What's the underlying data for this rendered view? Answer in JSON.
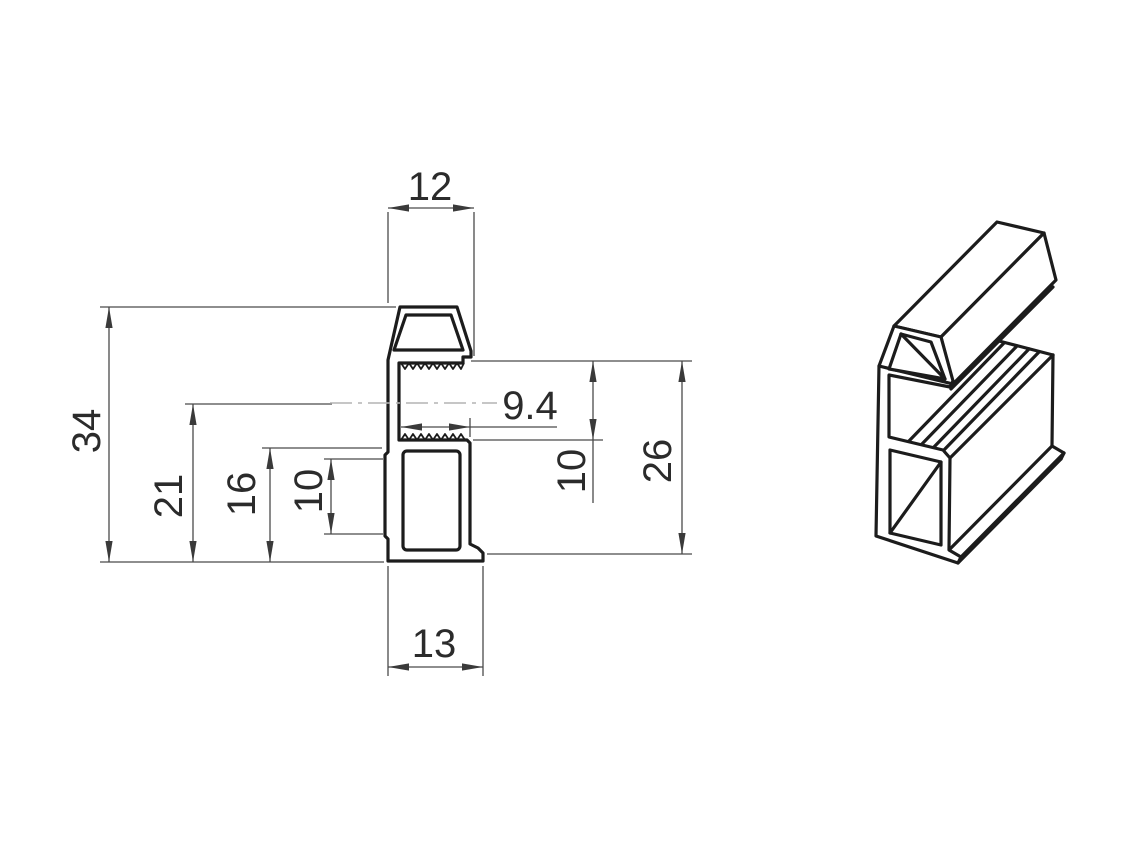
{
  "drawing": {
    "kind": "profile-technical-drawing",
    "views": [
      "cross-section",
      "isometric"
    ]
  },
  "colors": {
    "background": "#ffffff",
    "outline": "#1c1c1c",
    "dimension_lines": "#4a4a4a",
    "dimension_text": "#2b2b2b",
    "centerline": "#b4b4b4"
  },
  "dimensions": {
    "head_width": "12",
    "overall_height": "34",
    "centerline_height": "21",
    "body_height": "16",
    "recess_height": "10",
    "slot_depth": "9.4",
    "slot_height": "10",
    "side_height": "26",
    "base_width": "13"
  }
}
